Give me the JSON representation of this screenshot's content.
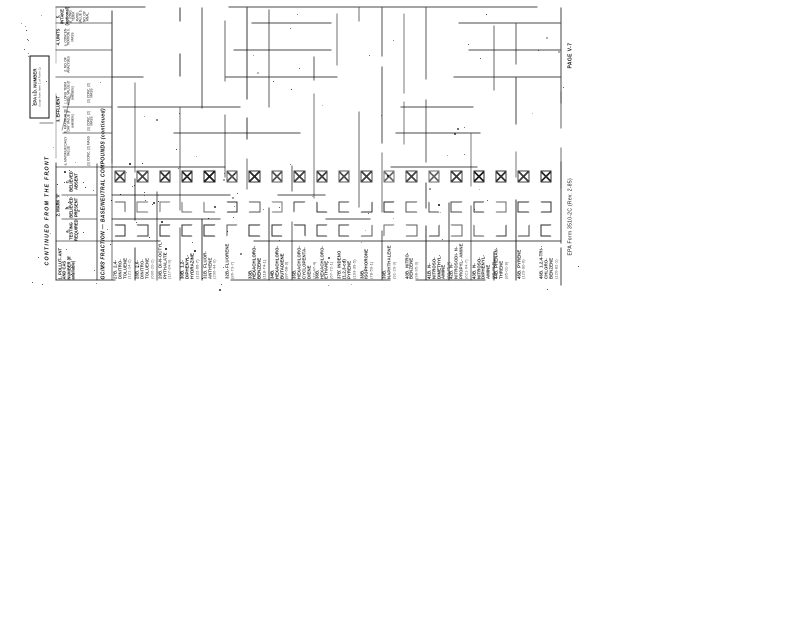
{
  "form": {
    "continued_header": "CONTINUED FROM THE FRONT",
    "epa_id_label": "EPA I.D. NUMBER",
    "epa_id_sub": "(copy from Item 1 of Form 1)",
    "section_title": "GC/MS FRACTION — BASE/NEUTRAL COMPOUNDS (continued)",
    "footer": "EPA Form 3510-2C (Rev. 2-85)",
    "page_label": "PAGE V-7"
  },
  "table": {
    "pollutant_header": "1. POLLUT- ANT AND CAS NUMBER (if available)",
    "mark_header": "2. MARK 'X'",
    "mark_cols": [
      {
        "key": "a",
        "label": "a. TESTING REQUIRED"
      },
      {
        "key": "b",
        "label": "b. BELIEVED PRESENT"
      },
      {
        "key": "c",
        "label": "c. BELIEVED ABSENT"
      }
    ],
    "effluent_header": "3. EFFLUENT",
    "effluent_cols": [
      "a. MAXIMUM DAILY VALUE",
      "b. MAXIMUM 30 DAY VALUE (if available)",
      "c. LONG TERM AVRG. VALUE (if available)",
      "d. NO. OF ANALYSES"
    ],
    "conc_mass": "(1) CONC. (2) MASS",
    "units_header": "4. UNITS",
    "units_sub": "a. CONCEN- TRATION  b. MASS",
    "intake_header": "5. INTAKE (optional)",
    "intake_sub": "a. LONG TERM AVRG. VALUE  b. NO. OF ANAL."
  },
  "rows": [
    {
      "id": "27B",
      "name": "2,4-DINITRO- TOLUENE",
      "cas": "(121-14-2)",
      "marks": {
        "a": false,
        "b": false,
        "c": true
      }
    },
    {
      "id": "28B",
      "name": "2,6-DINITRO- TOLUENE",
      "cas": "(606-20-2)",
      "marks": {
        "a": false,
        "b": false,
        "c": true
      }
    },
    {
      "id": "29B",
      "name": "DI-N-OCTYL PHTHALATE",
      "cas": "(117-84-0)",
      "marks": {
        "a": false,
        "b": false,
        "c": true
      }
    },
    {
      "id": "30B",
      "name": "1,2-DIPHENYL- HYDRAZINE",
      "cas": "(122-66-7)",
      "marks": {
        "a": false,
        "b": false,
        "c": true
      }
    },
    {
      "id": "31B",
      "name": "FLUOR- ANTHENE",
      "cas": "(206-44-0)",
      "marks": {
        "a": false,
        "b": false,
        "c": true
      }
    },
    {
      "id": "32B",
      "name": "FLUORENE",
      "cas": "(86-73-7)",
      "marks": {
        "a": false,
        "b": false,
        "c": true
      }
    },
    {
      "id": "33B",
      "name": "HEXACHLORO- BENZENE",
      "cas": "(118-74-1)",
      "marks": {
        "a": false,
        "b": false,
        "c": true
      }
    },
    {
      "id": "34B",
      "name": "HEXACHLORO- BUTADIENE",
      "cas": "(87-68-3)",
      "marks": {
        "a": false,
        "b": false,
        "c": true
      }
    },
    {
      "id": "35B",
      "name": "HEXACHLORO- CYCLOPENTA- DIENE",
      "cas": "(77-47-4)",
      "marks": {
        "a": false,
        "b": false,
        "c": true
      }
    },
    {
      "id": "36B",
      "name": "HEXACHLORO- ETHANE",
      "cas": "(67-72-1)",
      "marks": {
        "a": false,
        "b": false,
        "c": true
      }
    },
    {
      "id": "37B",
      "name": "INDENO (1,2,3-cd) PYRENE",
      "cas": "(193-39-5)",
      "marks": {
        "a": false,
        "b": false,
        "c": true
      }
    },
    {
      "id": "38B",
      "name": "ISOPHORONE",
      "cas": "(78-59-1)",
      "marks": {
        "a": false,
        "b": false,
        "c": true
      }
    },
    {
      "id": "39B",
      "name": "NAPHTHALENE",
      "cas": "(91-20-3)",
      "marks": {
        "a": false,
        "b": false,
        "c": true
      }
    },
    {
      "id": "40B",
      "name": "NITRO- BENZENE",
      "cas": "(98-95-3)",
      "marks": {
        "a": false,
        "b": false,
        "c": true
      }
    },
    {
      "id": "41B",
      "name": "N-NITROSO- DIMETHYL- AMINE",
      "cas": "(62-75-9)",
      "marks": {
        "a": false,
        "b": false,
        "c": true
      }
    },
    {
      "id": "42B",
      "name": "N-NITROSODI- N-PROPYL- AMINE",
      "cas": "(621-64-7)",
      "marks": {
        "a": false,
        "b": false,
        "c": true
      }
    },
    {
      "id": "43B",
      "name": "N-NITROSO- DIPHENYL- AMINE",
      "cas": "(86-30-6)",
      "marks": {
        "a": false,
        "b": false,
        "c": true
      }
    },
    {
      "id": "44B",
      "name": "PHENAN- THRENE",
      "cas": "(85-01-8)",
      "marks": {
        "a": false,
        "b": false,
        "c": true
      }
    },
    {
      "id": "45B",
      "name": "PYRENE",
      "cas": "(129-00-0)",
      "marks": {
        "a": false,
        "b": false,
        "c": true
      }
    },
    {
      "id": "46B",
      "name": "1,2,4-TRI- CHLORO- BENZENE",
      "cas": "(120-82-1)",
      "marks": {
        "a": false,
        "b": false,
        "c": true
      }
    }
  ],
  "colors": {
    "ink": "#141414",
    "paper": "#ffffff"
  }
}
